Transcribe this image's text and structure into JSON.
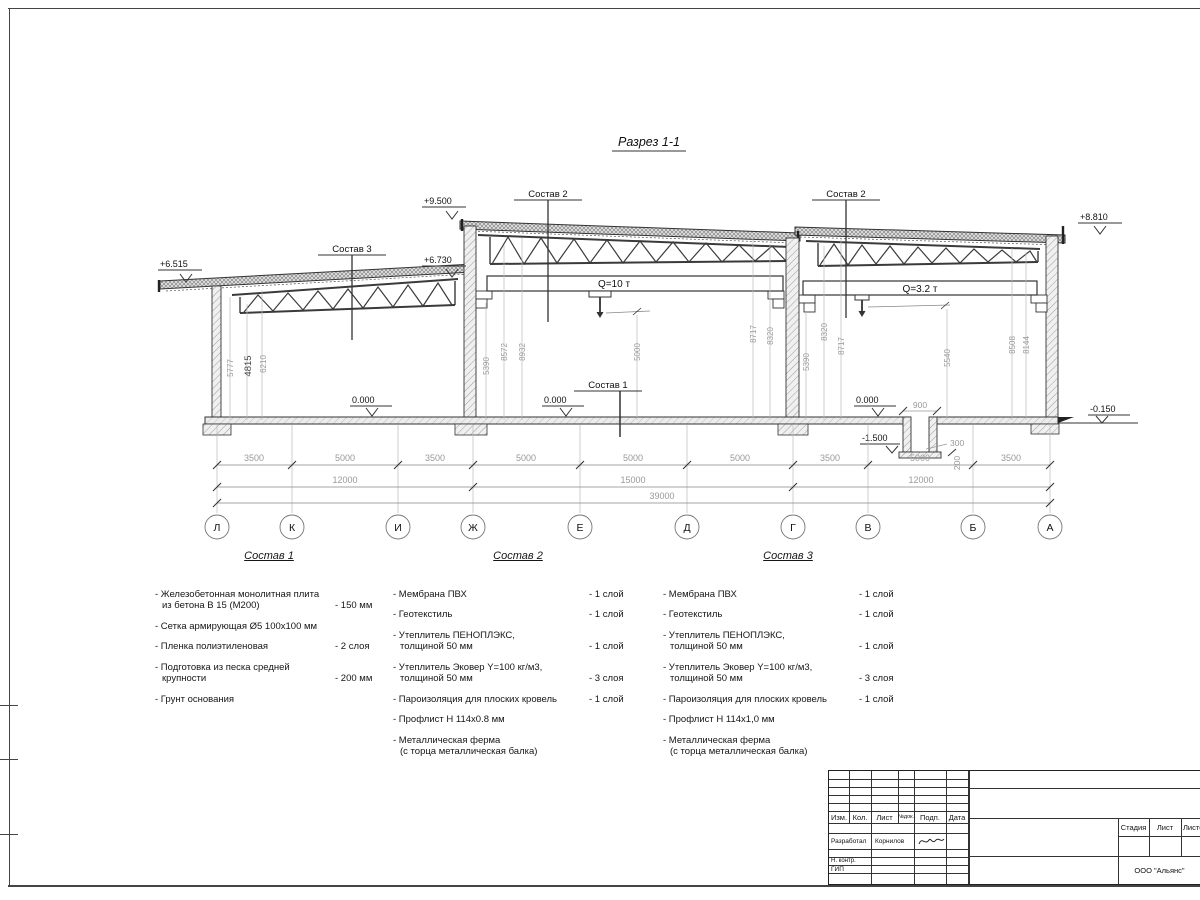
{
  "sheet": {
    "title": "Разрез 1-1",
    "marks": {
      "top_mid": "+9.500",
      "left_eave": "+6.515",
      "left_right": "+6.730",
      "right_eave": "+8.810",
      "zero_a": "0.000",
      "zero_b": "0.000",
      "zero_c": "0.000",
      "pit": "-1.500",
      "ground": "-0.150"
    },
    "callouts": {
      "c1": "Состав 1",
      "c2a": "Состав 2",
      "c2b": "Состав 2",
      "c3": "Состав 3"
    },
    "cranes": {
      "q10": "Q=10 т",
      "q32": "Q=3.2 т"
    },
    "vdims_left": [
      "5777",
      "4815",
      "6210"
    ],
    "vdims_mid": [
      "5390",
      "8572",
      "8932",
      "5000",
      "8717",
      "8320"
    ],
    "vdims_right": [
      "5390",
      "8320",
      "8717",
      "5540",
      "8508",
      "8144"
    ],
    "pit_dims": {
      "width": "900",
      "d300": "300",
      "d200": "200"
    },
    "dim_row1": [
      "3500",
      "5000",
      "3500",
      "5000",
      "5000",
      "5000",
      "3500",
      "5000",
      "3500"
    ],
    "dim_row2": [
      "12000",
      "15000",
      "12000"
    ],
    "dim_total": "39000",
    "axes": [
      "Л",
      "К",
      "И",
      "Ж",
      "Е",
      "Д",
      "Г",
      "В",
      "Б",
      "А"
    ]
  },
  "sostav1": {
    "title": "Состав 1",
    "items": [
      {
        "text": "- Железобетонная  монолитная плита\nиз бетона В 15 (М200)",
        "qty": "- 150 мм"
      },
      {
        "text": "- Сетка армирующая Ø5 100x100 мм",
        "qty": ""
      },
      {
        "text": "- Пленка полиэтиленовая",
        "qty": "-  2 слоя"
      },
      {
        "text": "- Подготовка из песка средней\nкрупности",
        "qty": "- 200 мм"
      },
      {
        "text": "- Грунт основания",
        "qty": ""
      }
    ]
  },
  "sostav2": {
    "title": "Состав 2",
    "items": [
      {
        "text": "- Мембрана ПВХ",
        "qty": "- 1 слой"
      },
      {
        "text": "- Геотекстиль",
        "qty": "- 1 слой"
      },
      {
        "text": "- Утеплитель ПЕНОПЛЭКС,\nтолщиной 50 мм",
        "qty": "- 1 слой"
      },
      {
        "text": "- Утеплитель Эковер Y=100 кг/м3,\nтолщиной 50 мм",
        "qty": "- 3 слоя"
      },
      {
        "text": "- Пароизоляция для плоских кровель",
        "qty": "- 1 слой"
      },
      {
        "text": "- Профлист Н 114x0.8 мм",
        "qty": ""
      },
      {
        "text": "- Металлическая ферма\n(с торца металлическая балка)",
        "qty": ""
      }
    ]
  },
  "sostav3": {
    "title": "Состав 3",
    "items": [
      {
        "text": "- Мембрана ПВХ",
        "qty": "- 1 слой"
      },
      {
        "text": "- Геотекстиль",
        "qty": "- 1 слой"
      },
      {
        "text": "- Утеплитель ПЕНОПЛЭКС,\nтолщиной 50 мм",
        "qty": "- 1 слой"
      },
      {
        "text": "- Утеплитель Эковер Y=100 кг/м3,\nтолщиной 50 мм",
        "qty": "- 3 слоя"
      },
      {
        "text": "- Пароизоляция для плоских кровель",
        "qty": "- 1 слой"
      },
      {
        "text": "- Профлист Н 114х1,0 мм",
        "qty": ""
      },
      {
        "text": "- Металлическая ферма\n(с торца металлическая балка)",
        "qty": ""
      }
    ]
  },
  "titleblock": {
    "cols": [
      "Изм.",
      "Кол.",
      "Лист",
      "№док.",
      "Подп.",
      "Дата"
    ],
    "rows": {
      "r1_role": "Разработал",
      "r1_name": "Корнилов",
      "r2_role": "Н. контр.",
      "r3_role": "ГИП"
    },
    "stage_cols": [
      "Стадия",
      "Лист",
      "Листов"
    ],
    "company": "ООО \"Альянс\""
  }
}
